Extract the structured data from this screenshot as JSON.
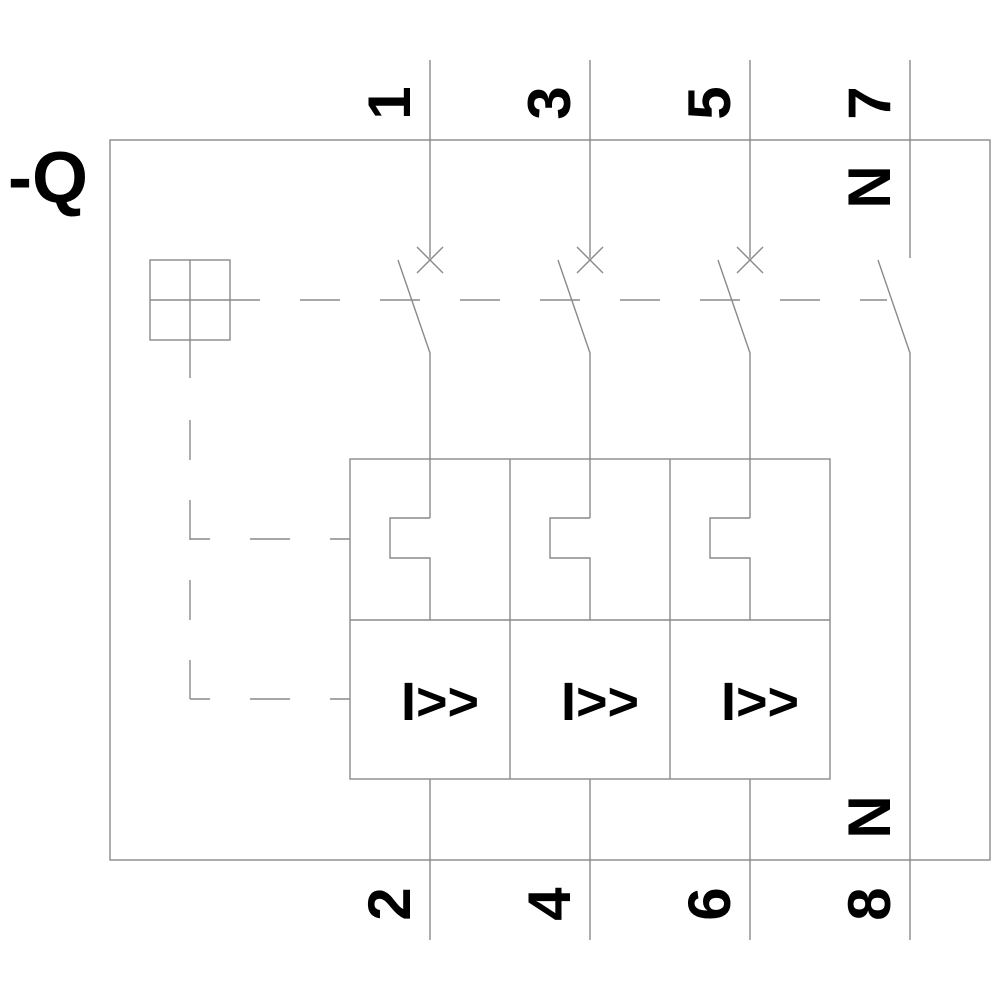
{
  "diagram": {
    "device_label": "-Q",
    "top_terminals": [
      "1",
      "3",
      "5",
      "7"
    ],
    "top_neutral_label": "N",
    "bottom_terminals": [
      "2",
      "4",
      "6",
      "8"
    ],
    "bottom_neutral_label": "N",
    "trip_unit_labels": [
      "I>>",
      "I>>",
      "I>>"
    ],
    "colors": {
      "line": "#8a8a8a",
      "text": "#000000",
      "background": "#ffffff"
    }
  }
}
